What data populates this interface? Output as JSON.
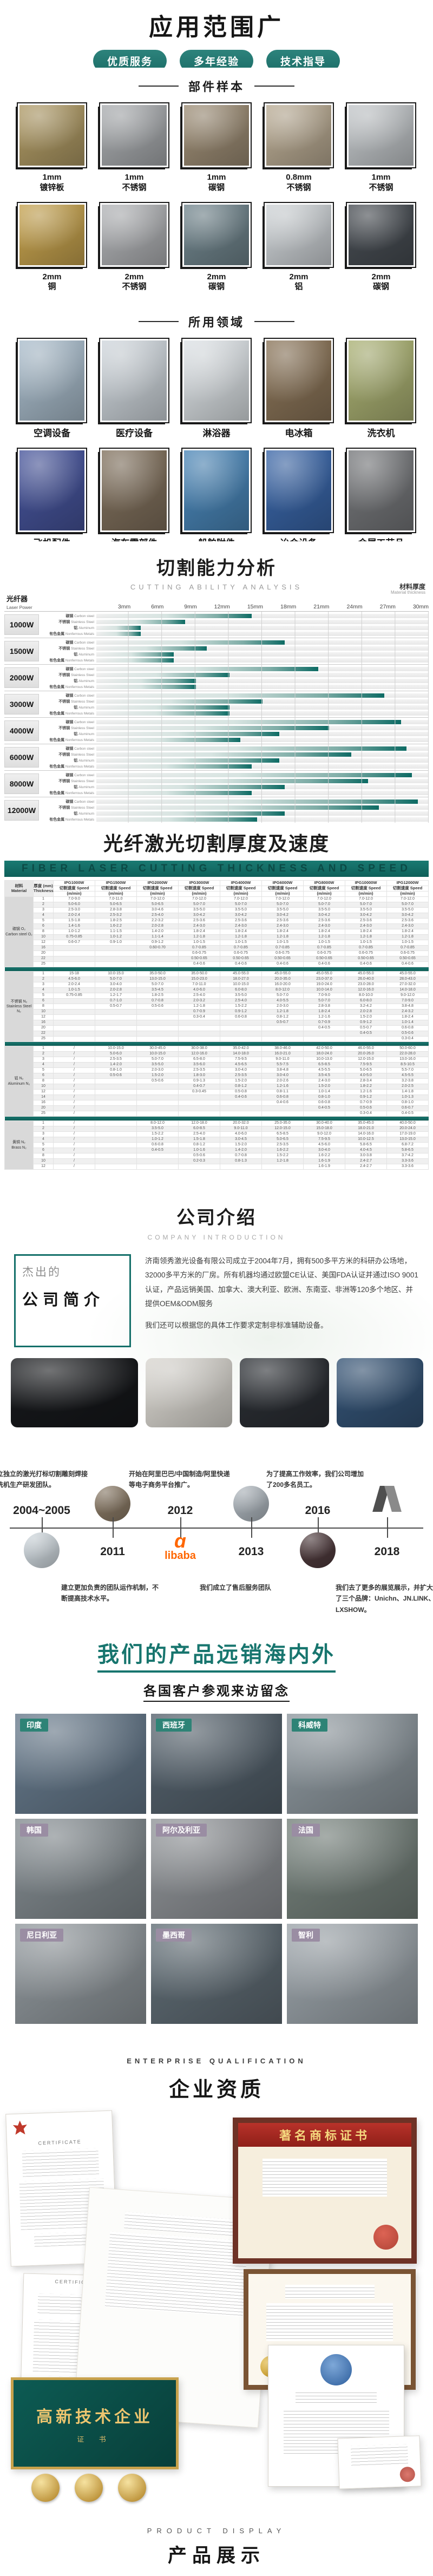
{
  "accent": "#17756e",
  "header": {
    "title": "应用范围广",
    "badges": [
      "优质服务",
      "多年经验",
      "技术指导"
    ]
  },
  "samples": {
    "title": "部件样本",
    "items": [
      {
        "size": "1mm",
        "material": "镀锌板",
        "tone": "#ae9964"
      },
      {
        "size": "1mm",
        "material": "不锈钢",
        "tone": "#a8abae"
      },
      {
        "size": "1mm",
        "material": "碳钢",
        "tone": "#9c8c74"
      },
      {
        "size": "0.8mm",
        "material": "不锈钢",
        "tone": "#b9ab93"
      },
      {
        "size": "1mm",
        "material": "不锈钢",
        "tone": "#c2c6c9"
      },
      {
        "size": "2mm",
        "material": "铜",
        "tone": "#c5a24e"
      },
      {
        "size": "2mm",
        "material": "不锈钢",
        "tone": "#b0b2b5"
      },
      {
        "size": "2mm",
        "material": "碳钢",
        "tone": "#70848c"
      },
      {
        "size": "2mm",
        "material": "铝",
        "tone": "#ced3d6"
      },
      {
        "size": "2mm",
        "material": "碳钢",
        "tone": "#474c52"
      }
    ]
  },
  "fields": {
    "title": "所用领域",
    "items": [
      {
        "label": "空调设备",
        "tone": "#a9bccb"
      },
      {
        "label": "医疗设备",
        "tone": "#cfd6dc"
      },
      {
        "label": "淋浴器",
        "tone": "#dde2e6"
      },
      {
        "label": "电冰箱",
        "tone": "#8a7458"
      },
      {
        "label": "洗衣机",
        "tone": "#aab173"
      },
      {
        "label": "飞机配件",
        "tone": "#46549b"
      },
      {
        "label": "汽车零部件",
        "tone": "#80705c"
      },
      {
        "label": "船舶附件",
        "tone": "#4a86b8"
      },
      {
        "label": "冶金设备",
        "tone": "#3a66a8"
      },
      {
        "label": "金属工艺品",
        "tone": "#75777a"
      }
    ]
  },
  "chart_section": {
    "title": "切割能力分析",
    "subtitle": "CUTTING ABILITY ANALYSIS",
    "right_label_zh": "材料厚度",
    "right_label_en": "Material thickness",
    "axis_label_zh": "光纤器",
    "axis_label_en": "Laser Power",
    "legend": "最大切割厚度（平板试切原材料）"
  },
  "chart_data": {
    "type": "bar",
    "orientation": "horizontal",
    "title": "切割能力分析",
    "xlabel": "材料厚度 Material thickness (mm)",
    "ylabel": "光纤器 Laser Power",
    "xlim": [
      0,
      30
    ],
    "ticks": [
      "3mm",
      "6mm",
      "9mm",
      "12mm",
      "15mm",
      "18mm",
      "21mm",
      "24mm",
      "27mm",
      "30mm"
    ],
    "grid": true,
    "legend_position": "bottom-right",
    "materials": [
      {
        "zh": "碳钢",
        "en": "Carbon steel"
      },
      {
        "zh": "不锈钢",
        "en": "Stainless Steel"
      },
      {
        "zh": "铝",
        "en": "Aluminum"
      },
      {
        "zh": "有色金属",
        "en": "Nonferrous Metals"
      }
    ],
    "groups": [
      {
        "power": "1000W",
        "values": [
          14,
          8,
          4,
          4
        ]
      },
      {
        "power": "1500W",
        "values": [
          17,
          10,
          7,
          7
        ]
      },
      {
        "power": "2000W",
        "values": [
          20,
          12,
          9,
          9
        ]
      },
      {
        "power": "3000W",
        "values": [
          26,
          15,
          12,
          12
        ]
      },
      {
        "power": "4000W",
        "values": [
          27.5,
          21,
          16.5,
          13
        ]
      },
      {
        "power": "6000W",
        "values": [
          28,
          23,
          16.5,
          14
        ]
      },
      {
        "power": "8000W",
        "values": [
          28.5,
          24.5,
          17,
          14
        ]
      },
      {
        "power": "12000W",
        "values": [
          29,
          25.5,
          17,
          14.5
        ]
      }
    ],
    "bar_color_end": "#0d6b64"
  },
  "speed_table": {
    "title": "光纤激光切割厚度及速度",
    "banner": "FIBER LASER CUTTING THICKNESS AND SPEED",
    "material_header_zh": "材料",
    "material_header_en": "Material",
    "thickness_header_zh": "厚度 (mm)",
    "thickness_header_en": "Thickness",
    "speed_label": "切割速度 Speed",
    "unit_label": "(m/min)",
    "models": [
      "IPG1000W",
      "IPG1500W",
      "IPG2000W",
      "IPG3000W",
      "IPG4000W",
      "IPG6000W",
      "IPG8000W",
      "IPG10000W",
      "IPG12000W"
    ],
    "sections": [
      {
        "zh": "碳钢 O₂",
        "en": "Carbon steel O₂",
        "rows": [
          [
            "1",
            "7.0-9.0",
            "7.0-11.0",
            "7.0-12.0",
            "7.0-12.0",
            "7.0-12.0",
            "7.0-12.0",
            "7.0-12.0",
            "7.0-12.0",
            "7.0-12.0"
          ],
          [
            "2",
            "5.0-6.0",
            "5.0-6.5",
            "5.0-6.5",
            "5.0-7.0",
            "5.0-7.0",
            "5.0-7.0",
            "5.0-7.0",
            "5.0-7.0",
            "5.0-7.0"
          ],
          [
            "3",
            "2.5-3.0",
            "2.8-3.8",
            "3.0-4.6",
            "3.5-5.0",
            "3.5-5.0",
            "3.5-5.0",
            "3.5-5.0",
            "3.5-5.0",
            "3.5-5.0"
          ],
          [
            "4",
            "2.0-2.4",
            "2.5-3.2",
            "2.5-4.0",
            "3.0-4.2",
            "3.0-4.2",
            "3.0-4.2",
            "3.0-4.2",
            "3.0-4.2",
            "3.0-4.2"
          ],
          [
            "5",
            "1.5-1.8",
            "1.8-2.5",
            "2.2-3.2",
            "2.5-3.6",
            "2.5-3.6",
            "2.5-3.6",
            "2.5-3.6",
            "2.5-3.6",
            "2.5-3.6"
          ],
          [
            "6",
            "1.4-1.6",
            "1.6-2.2",
            "2.0-2.8",
            "2.4-3.0",
            "2.4-3.0",
            "2.4-3.0",
            "2.4-3.0",
            "2.4-3.0",
            "2.4-3.0"
          ],
          [
            "8",
            "1.0-1.2",
            "1.1-1.5",
            "1.4-2.0",
            "1.8-2.4",
            "1.8-2.4",
            "1.8-2.4",
            "1.8-2.4",
            "1.8-2.4",
            "1.8-2.4"
          ],
          [
            "10",
            "0.75-0.85",
            "1.0-1.2",
            "1.1-1.4",
            "1.2-1.8",
            "1.2-1.8",
            "1.2-1.8",
            "1.2-1.8",
            "1.2-1.8",
            "1.2-1.8"
          ],
          [
            "12",
            "0.6-0.7",
            "0.9-1.0",
            "0.9-1.2",
            "1.0-1.5",
            "1.0-1.5",
            "1.0-1.5",
            "1.0-1.5",
            "1.0-1.5",
            "1.0-1.5"
          ],
          [
            "16",
            "",
            "",
            "0.60-0.70",
            "0.7-0.85",
            "0.7-0.85",
            "0.7-0.85",
            "0.7-0.85",
            "0.7-0.85",
            "0.7-0.85"
          ],
          [
            "20",
            "",
            "",
            "",
            "0.6-0.75",
            "0.6-0.75",
            "0.6-0.75",
            "0.6-0.75",
            "0.6-0.75",
            "0.6-0.75"
          ],
          [
            "22",
            "",
            "",
            "",
            "0.50-0.65",
            "0.50-0.65",
            "0.50-0.65",
            "0.50-0.65",
            "0.50-0.65",
            "0.50-0.65"
          ],
          [
            "25",
            "",
            "",
            "",
            "0.4-0.6",
            "0.4-0.6",
            "0.4-0.6",
            "0.4-0.6",
            "0.4-0.6",
            "0.4-0.6"
          ]
        ]
      },
      {
        "zh": "不锈钢 N₂",
        "en": "Stainless Steel N₂",
        "rows": [
          [
            "1",
            "15-18",
            "10.0-15.0",
            "35.0-50.0",
            "35.0-50.0",
            "45.0-55.0",
            "45.0-55.0",
            "45.0-55.0",
            "45.0-55.0",
            "45.0-55.0"
          ],
          [
            "2",
            "4.5-6.0",
            "5.0-7.0",
            "13.0-15.0",
            "15.0-23.0",
            "18.0-27.0",
            "20.0-35.0",
            "23.0-37.0",
            "26.0-40.0",
            "28.0-43.0"
          ],
          [
            "3",
            "2.0-2.4",
            "3.0-4.0",
            "5.0-7.0",
            "7.0-11.0",
            "10.0-15.0",
            "16.0-20.0",
            "19.0-24.0",
            "23.0-28.0",
            "27.0-32.0"
          ],
          [
            "4",
            "1.0-1.5",
            "2.0-2.8",
            "3.5-4.5",
            "4.0-6.0",
            "6.0-8.0",
            "8.0-12.0",
            "10.0-14.0",
            "12.0-16.0",
            "14.0-18.0"
          ],
          [
            "5",
            "0.75-0.85",
            "1.2-1.7",
            "1.8-2.5",
            "2.5-4.0",
            "3.5-5.0",
            "5.0-7.0",
            "7.0-9.0",
            "8.0-10.0",
            "9.0-12.0"
          ],
          [
            "6",
            "",
            "0.7-1.0",
            "0.7-0.8",
            "2.0-3.2",
            "2.5-4.0",
            "4.0-5.5",
            "5.0-7.0",
            "6.0-8.0",
            "7.0-9.0"
          ],
          [
            "8",
            "",
            "0.5-0.7",
            "0.5-0.6",
            "1.2-1.8",
            "1.5-2.2",
            "2.0-3.0",
            "2.8-3.8",
            "3.2-4.2",
            "3.8-4.8"
          ],
          [
            "10",
            "",
            "",
            "",
            "0.7-0.9",
            "0.9-1.2",
            "1.2-1.8",
            "1.8-2.4",
            "2.0-2.8",
            "2.4-3.2"
          ],
          [
            "12",
            "",
            "",
            "",
            "0.3-0.4",
            "0.6-0.8",
            "0.8-1.2",
            "1.2-1.6",
            "1.5-2.0",
            "1.8-2.4"
          ],
          [
            "16",
            "",
            "",
            "",
            "",
            "",
            "0.5-0.7",
            "0.7-0.9",
            "0.9-1.2",
            "1.0-1.4"
          ],
          [
            "20",
            "",
            "",
            "",
            "",
            "",
            "",
            "0.4-0.5",
            "0.5-0.7",
            "0.6-0.8"
          ],
          [
            "22",
            "",
            "",
            "",
            "",
            "",
            "",
            "",
            "0.4-0.5",
            "0.5-0.6"
          ],
          [
            "25",
            "",
            "",
            "",
            "",
            "",
            "",
            "",
            "",
            "0.3-0.4"
          ]
        ]
      },
      {
        "zh": "铝 N₂",
        "en": "Aluminum N₂",
        "rows": [
          [
            "1",
            "/",
            "10.0-15.0",
            "30.0-45.0",
            "30.0-38.0",
            "35.0-42.0",
            "38.0-46.0",
            "42.0-50.0",
            "46.0-55.0",
            "50.0-60.0"
          ],
          [
            "2",
            "/",
            "5.0-6.0",
            "10.0-15.0",
            "12.0-16.0",
            "14.0-18.0",
            "16.0-21.0",
            "18.0-24.0",
            "20.0-26.0",
            "22.0-28.0"
          ],
          [
            "3",
            "/",
            "2.5-3.5",
            "5.0-7.0",
            "6.5-8.0",
            "7.5-9.5",
            "9.0-11.0",
            "10.0-13.0",
            "12.0-15.0",
            "13.0-16.0"
          ],
          [
            "4",
            "/",
            "1.4-2.0",
            "3.5-5.0",
            "3.5-6.0",
            "4.5-6.5",
            "5.5-7.5",
            "6.5-8.5",
            "7.5-9.5",
            "8.5-10.5"
          ],
          [
            "5",
            "/",
            "0.8-1.0",
            "2.0-3.0",
            "2.5-3.5",
            "3.0-4.0",
            "3.8-4.8",
            "4.5-5.5",
            "5.0-6.5",
            "5.5-7.0"
          ],
          [
            "6",
            "/",
            "0.5-0.6",
            "1.5-2.0",
            "1.8-3.0",
            "2.5-3.5",
            "3.0-4.0",
            "3.5-4.5",
            "4.0-5.0",
            "4.5-5.5"
          ],
          [
            "8",
            "/",
            "",
            "0.5-0.6",
            "0.9-1.3",
            "1.5-2.0",
            "2.0-2.6",
            "2.4-3.0",
            "2.8-3.4",
            "3.2-3.8"
          ],
          [
            "10",
            "/",
            "",
            "",
            "0.4-0.7",
            "0.8-1.2",
            "1.2-1.6",
            "1.5-2.0",
            "1.8-2.2",
            "2.0-2.5"
          ],
          [
            "12",
            "/",
            "",
            "",
            "0.3-0.45",
            "0.5-0.8",
            "0.8-1.1",
            "1.0-1.4",
            "1.2-1.6",
            "1.4-1.8"
          ],
          [
            "14",
            "/",
            "",
            "",
            "",
            "0.4-0.6",
            "0.6-0.8",
            "0.8-1.0",
            "0.9-1.2",
            "1.0-1.3"
          ],
          [
            "16",
            "/",
            "",
            "",
            "",
            "",
            "0.4-0.6",
            "0.6-0.8",
            "0.7-0.9",
            "0.8-1.0"
          ],
          [
            "20",
            "/",
            "",
            "",
            "",
            "",
            "",
            "0.4-0.5",
            "0.5-0.6",
            "0.6-0.7"
          ],
          [
            "25",
            "/",
            "",
            "",
            "",
            "",
            "",
            "",
            "0.3-0.4",
            "0.4-0.5"
          ]
        ]
      },
      {
        "zh": "黄铜 N₂",
        "en": "Brass N₂",
        "rows": [
          [
            "1",
            "/",
            "",
            "8.0-12.0",
            "12.0-18.0",
            "20.0-32.0",
            "25.0-35.0",
            "30.0-40.0",
            "35.0-45.0",
            "40.0-50.0"
          ],
          [
            "2",
            "/",
            "",
            "3.5-5.0",
            "6.0-8.5",
            "9.0-11.0",
            "12.0-15.0",
            "15.0-18.0",
            "18.0-21.0",
            "20.0-24.0"
          ],
          [
            "3",
            "/",
            "",
            "1.5-2.2",
            "2.5-4.0",
            "4.0-6.0",
            "6.5-8.5",
            "9.0-12.0",
            "14.0-16.0",
            "17.0-19.0"
          ],
          [
            "4",
            "/",
            "",
            "1.0-1.2",
            "1.5-1.8",
            "3.0-4.5",
            "5.0-6.5",
            "7.5-9.5",
            "10.0-12.5",
            "13.0-15.0"
          ],
          [
            "5",
            "/",
            "",
            "0.6-0.8",
            "0.8-1.2",
            "1.5-2.0",
            "2.5-3.5",
            "4.5-6.0",
            "5.8-6.5",
            "6.8-7.2"
          ],
          [
            "6",
            "/",
            "",
            "0.4-0.5",
            "1.0-1.6",
            "1.4-2.0",
            "1.6-2.2",
            "3.0-4.0",
            "4.0-4.5",
            "5.8-6.5"
          ],
          [
            "8",
            "/",
            "",
            "",
            "0.5-0.6",
            "0.7-0.8",
            "1.5-2.2",
            "1.6-2.2",
            "3.0-3.8",
            "3.7-4.2"
          ],
          [
            "10",
            "/",
            "",
            "",
            "0.2-0.3",
            "0.8-1.3",
            "1.2-1.8",
            "1.6-1.9",
            "2.4-2.7",
            "3.3-3.6"
          ],
          [
            "12",
            "/",
            "",
            "",
            "",
            "",
            "",
            "1.6-1.9",
            "2.4-2.7",
            "3.3-3.6"
          ]
        ]
      }
    ]
  },
  "company": {
    "title": "公司介绍",
    "subtitle": "COMPANY INTRODUCTION",
    "box_small": "杰出的",
    "box_big": "公司简介",
    "paragraphs": [
      "济南领秀激光设备有限公司成立于2004年7月，拥有500多平方米的科研办公场地，32000多平方米的厂房。所有机器均通过欧盟CE认证、美国FDA认证并通过ISO 9001认证，产品远销美国、加拿大、澳大利亚、欧洲、东南亚、非洲等120多个地区、并提供OEM&ODM服务",
      "我们还可以根据您的具体工作要求定制非标准辅助设备。"
    ],
    "photo_tones": [
      "#16181b",
      "#d9d6d0",
      "#2a2e33",
      "#335274"
    ]
  },
  "timeline": {
    "events": [
      {
        "year": "2004~2005",
        "text": "成立独立的激光打标切割雕刻焊接清洗机生产研发团队。",
        "side": "year-top",
        "media": "photo",
        "tone": "#cfd8de"
      },
      {
        "year": "2011",
        "text": "建立更加负责的团队运作机制，不断提高技术水平。",
        "side": "year-bottom",
        "media": "photo",
        "tone": "#8a7a66"
      },
      {
        "year": "2012",
        "text": "开始在阿里巴巴/中国制造/阿里快递等电子商务平台推广。",
        "side": "year-top",
        "media": "alibaba",
        "alibaba_text": "libaba"
      },
      {
        "year": "2013",
        "text": "我们成立了售后服务团队",
        "side": "year-bottom",
        "media": "photo",
        "tone": "#aeb6bd"
      },
      {
        "year": "2016",
        "text": "为了提高工作效率，我们公司增加了200多名员工。",
        "side": "year-top",
        "media": "photo",
        "tone": "#4e3a3c"
      },
      {
        "year": "2018",
        "text": "我们去了更多的展览展示，并扩大了三个品牌：Unichn、JN.LINK、LXSHOW。",
        "side": "year-bottom",
        "media": "geo"
      }
    ]
  },
  "products": {
    "heading": "我们的产品远销海内外",
    "subheading": "各国客户参观来访留念",
    "photos": [
      {
        "label": "印度",
        "badge": "#2e8376",
        "tone": "#65788a"
      },
      {
        "label": "西班牙",
        "badge": "#2e8376",
        "tone": "#54616c"
      },
      {
        "label": "科威特",
        "badge": "#2e8376",
        "tone": "#8d979e"
      },
      {
        "label": "韩国",
        "badge": "#9a8da3",
        "tone": "#828a8f"
      },
      {
        "label": "阿尔及利亚",
        "badge": "#9a8da3",
        "tone": "#8e9296"
      },
      {
        "label": "法国",
        "badge": "#9a8da3",
        "tone": "#74807a"
      },
      {
        "label": "尼日利亚",
        "badge": "#9a8da3",
        "tone": "#90979c"
      },
      {
        "label": "墨西哥",
        "badge": "#9a8da3",
        "tone": "#5f6c74"
      },
      {
        "label": "智利",
        "badge": "#9a8da3",
        "tone": "#9ba3a9"
      }
    ]
  },
  "quals": {
    "title_en": "ENTERPRISE QUALIFICATION",
    "title_zh": "企业资质",
    "trademark_label": "著名商标证书",
    "hitech_label": "高新技术企业",
    "hitech_sub": "证 书",
    "ce_head": "CERTIFICATE"
  },
  "footer": {
    "en": "PRODUCT DISPLAY",
    "zh": "产品展示"
  }
}
